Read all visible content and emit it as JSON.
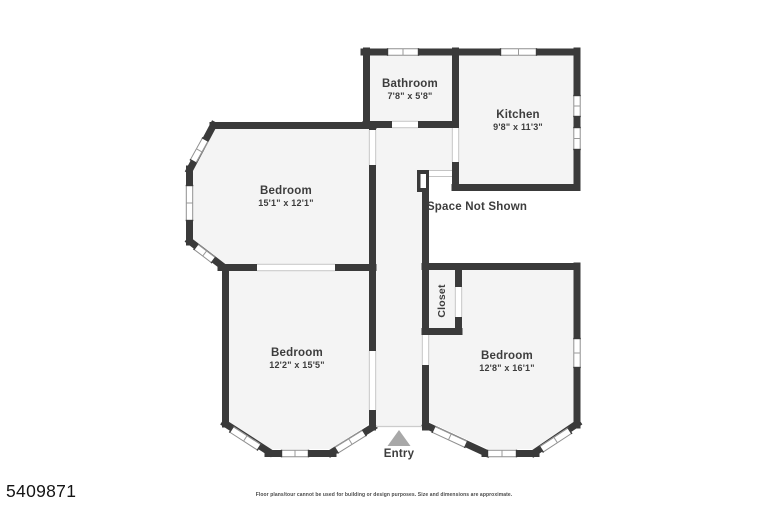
{
  "floorplan": {
    "rooms": [
      {
        "name": "Bathroom",
        "dims": "7'8\" x 5'8\""
      },
      {
        "name": "Kitchen",
        "dims": "9'8\" x 11'3\""
      },
      {
        "name": "Bedroom",
        "dims": "15'1\" x 12'1\""
      },
      {
        "name": "Bedroom",
        "dims": "12'2\" x 15'5\""
      },
      {
        "name": "Bedroom",
        "dims": "12'8\" x 16'1\""
      },
      {
        "name": "Closet"
      }
    ],
    "annotations": {
      "space_not_shown": "Space Not Shown",
      "entry": "Entry"
    }
  },
  "footer": {
    "listing_id": "5409871",
    "disclaimer": "Floor plans/tour cannot be used for building or design purposes. Size and dimensions are approximate."
  },
  "colors": {
    "wall": "#3a3a3a",
    "floor": "#f4f4f4",
    "background": "#ffffff",
    "entry_arrow": "#a8a8a8",
    "label_text": "#3d3d3d"
  }
}
